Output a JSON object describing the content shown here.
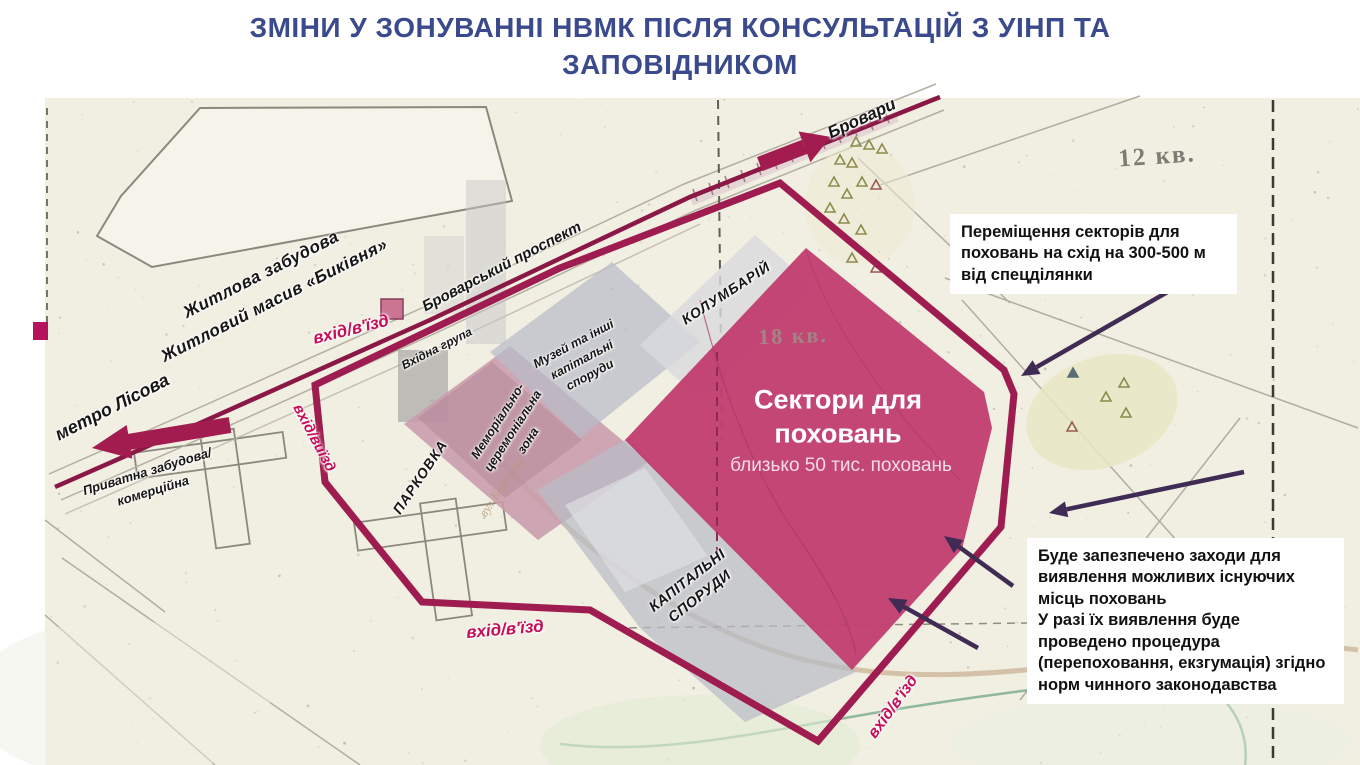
{
  "title": {
    "text": "ЗМІНИ У ЗОНУВАННІ НВМК ПІСЛЯ КОНСУЛЬТАЦІЙ З УІНП ТА\nЗАПОВІДНИКОМ"
  },
  "map_labels": {
    "residential": "Житлова забудова\nЖитловий масив «Биківня»",
    "metro": "метро Лісова",
    "prospect": "Броварський проспект",
    "brovary": "Бровари",
    "private_area": "Приватна забудова/\nкомерційна",
    "beregova_street": "вул.Берегова",
    "entrance_top": "вхід/в'їзд",
    "entrance_left": "вхід/виїзд",
    "entrance_bottom": "вхід/в'їзд",
    "entrance_southeast": "вхід/в'їзд",
    "entry_group": "Вхідна група",
    "museum": "Музей та інші\nкапітальні\nспоруди",
    "memorial_zone": "Меморіально-\nцеремоніальна\nзона",
    "columbarium": "КОЛУМБАРІЙ",
    "parking": "ПАРКОВКА",
    "capital_structures": "КАПІТАЛЬНІ\nСПОРУДИ",
    "quadrant_12": "12 кв.",
    "quadrant_18": "18 кв."
  },
  "sectors": {
    "title": "Сектори для\nпоховань",
    "subtitle": "близько 50 тис. поховань"
  },
  "annotations": {
    "relocation": "Переміщення секторів для\nпоховань на схід на 300-500 м\nвід спецділянки",
    "procedure": "Буде запезпечено заходи для\nвиявлення можливих існуючих\nмісць поховань\nУ разі їх виявлення  буде\nпроведено процедура\n(перепоховання, екзгумація) згідно\nнорм чинного законодавства"
  },
  "colors": {
    "title_navy": "#3b4a8d",
    "boundary_magenta": "#9e1c50",
    "road_magenta": "#8a1746",
    "sectors_fill": "#c13e70",
    "entrance_pink": "#c50d58",
    "annotation_arrow_purple": "#3f2b54",
    "map_background": "#f1eee2"
  }
}
